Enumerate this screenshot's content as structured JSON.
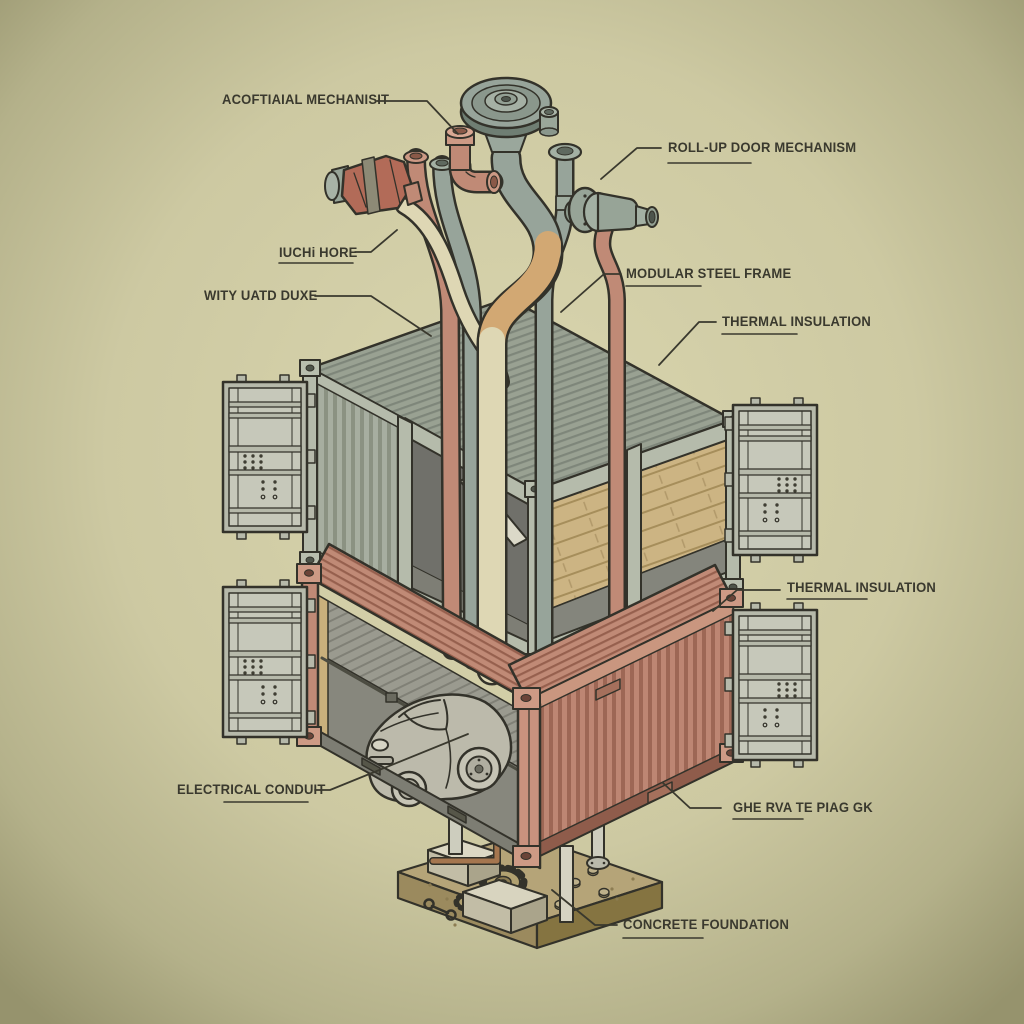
{
  "diagram": {
    "type": "exploded-isometric-technical-illustration",
    "subject": "Two stacked shipping containers converted to a home/garage, with plumbing manifold on top, open cargo doors, car inside lower container, and concrete foundation",
    "labels": [
      {
        "id": "actuator",
        "text": "ACOFTIAIAL MECHANISIT",
        "underlined": false,
        "side": "top-left"
      },
      {
        "id": "roll-up-door",
        "text": "ROLL-UP DOOR MECHANISM",
        "underlined": true,
        "side": "top-right"
      },
      {
        "id": "hose",
        "text": "IUCHi HORE",
        "underlined": true,
        "side": "left"
      },
      {
        "id": "duct",
        "text": "WITY UATD DUXE",
        "underlined": false,
        "side": "left"
      },
      {
        "id": "steel-frame",
        "text": "MODULAR STEEL FRAME",
        "underlined": true,
        "side": "right"
      },
      {
        "id": "thermal-upper",
        "text": "THERMAL INSULATION",
        "underlined": true,
        "side": "right"
      },
      {
        "id": "thermal-lower",
        "text": "THERMAL INSULATION",
        "underlined": true,
        "side": "right"
      },
      {
        "id": "electrical",
        "text": "ELECTRICAL CONDUIT",
        "underlined": true,
        "side": "bottom-left"
      },
      {
        "id": "cladding",
        "text": "GHE RVA TE PIAG GK",
        "underlined": true,
        "side": "bottom-right"
      },
      {
        "id": "foundation",
        "text": "CONCRETE FOUNDATION",
        "underlined": true,
        "side": "bottom"
      }
    ],
    "components": [
      "valve-wheel",
      "pipe-manifold",
      "red-shutoff-valve",
      "cream-hose",
      "elbow-fitting",
      "roll-up-door-motor",
      "flanged-pipe",
      "upper-container-gray",
      "lower-container-red",
      "wood-insulation-wall",
      "diagonal-beam",
      "cargo-doors-x4",
      "hatchback-car",
      "electrical-conduit-run",
      "support-posts",
      "concrete-piers",
      "foundation-slab",
      "gears-bolts-wrench",
      "copper-pipe"
    ],
    "palette": {
      "background_center": "#d9d5ae",
      "background_edge": "#96936d",
      "ink": "#33322a",
      "label_text": "#3a392e",
      "container_gray": "#a7aea0",
      "container_gray_dark": "#8b9282",
      "container_red": "#bd8673",
      "container_red_dark": "#9d6755",
      "wood": "#ccb483",
      "door_gray": "#b6b9aa",
      "pipe_green": "#97a49a",
      "pipe_tan": "#d2a873",
      "pipe_cream": "#ded7b4",
      "pipe_salmon": "#c08a76",
      "valve_red": "#b26b58",
      "foundation_sand": "#b5a478",
      "concrete_pier": "#d9d5c1",
      "gear_brass": "#b1a170"
    }
  }
}
